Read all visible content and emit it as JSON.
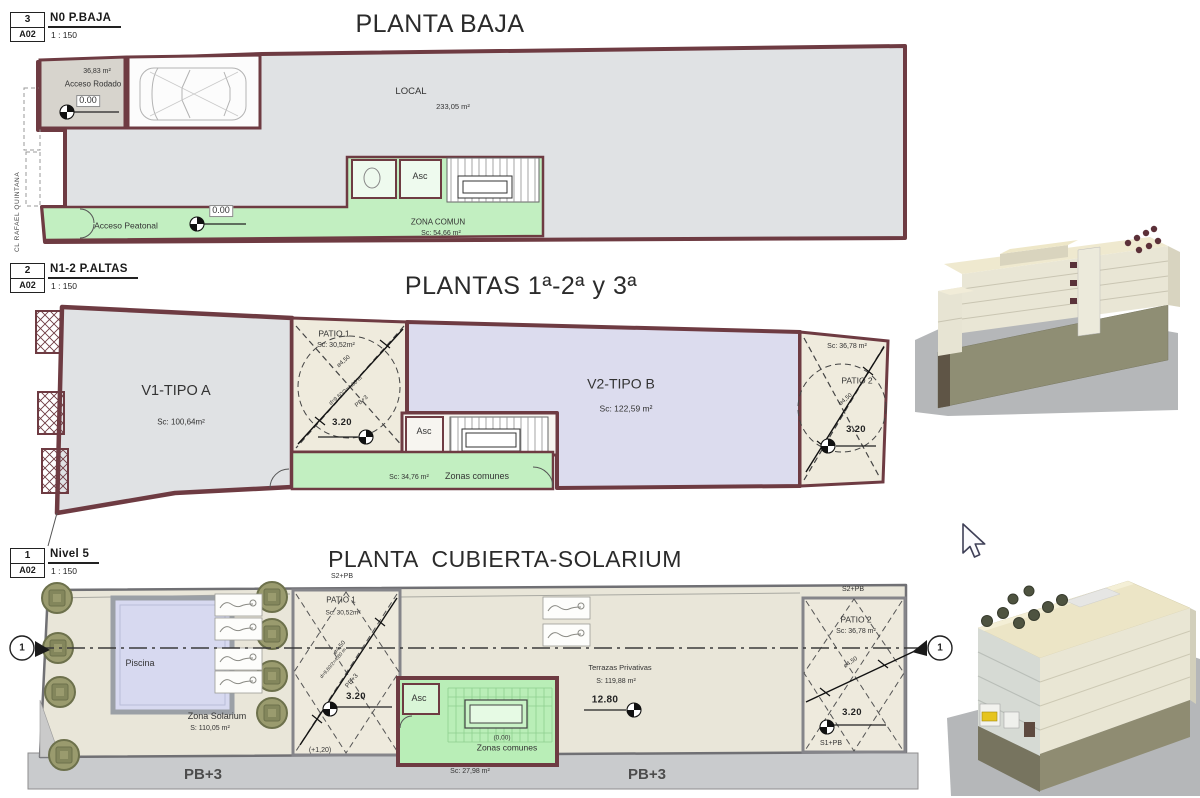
{
  "baja": {
    "ref": {
      "num": "3",
      "sheet": "A02",
      "name": "N0 P.BAJA",
      "scale": "1 : 150"
    },
    "title": "PLANTA BAJA",
    "street": "CL RAFAEL QUINTANA",
    "acceso_rodado_area": "36,83 m²",
    "acceso_rodado": "Acceso Rodado",
    "level_garage": "0.00",
    "local": "LOCAL",
    "local_area": "233,05 m²",
    "asc": "Asc",
    "acceso_peatonal": "Acceso Peatonal",
    "level_corridor": "0.00",
    "zona_comun": "ZONA COMUN",
    "zona_comun_area": "Sc: 54,66 m²"
  },
  "altas": {
    "ref": {
      "num": "2",
      "sheet": "A02",
      "name": "N1-2 P.ALTAS",
      "scale": "1 : 150"
    },
    "title": "PLANTAS 1ª-2ª y 3ª",
    "v1": "V1-TIPO A",
    "v1_area": "Sc: 100,64m²",
    "patio1": "PATIO 1",
    "patio1_area": "Sc: 30,52m²",
    "patio1_dia": "ø4,50",
    "patio1_dim": "d=9,60/2=4,80 m",
    "patio1_pb": "PB+3",
    "patio1_level": "3.20",
    "asc": "Asc",
    "zc_area": "Sc: 34,76 m²",
    "zc": "Zonas comunes",
    "v2": "V2-TIPO B",
    "v2_area": "Sc: 122,59 m²",
    "patio2_area": "Sc: 36,78 m²",
    "patio2": "PATIO 2",
    "patio2_dia": "ø4,50",
    "patio2_level": "3.20"
  },
  "cubierta": {
    "ref": {
      "num": "1",
      "sheet": "A02",
      "name": "Nivel 5",
      "scale": "1 : 150"
    },
    "title": "PLANTA CUBIERTA-SOLARIUM",
    "s2pb_left": "S2+PB",
    "s2pb_right": "S2+PB",
    "s1pb": "S1+PB",
    "patio1": "PATIO 1",
    "patio1_area": "Sc: 30,52m²",
    "piscina": "Piscina",
    "solarium": "Zona Solarium",
    "solarium_area": "S: 110,05 m²",
    "patio1_dia": "ø4,50",
    "patio1_dim": "d=9,60/2=4,80 m",
    "patio1_pb": "PB+3",
    "patio1_level": "3.20",
    "plus120": "(+1,20)",
    "asc": "Asc",
    "zc_level": "(0,00)",
    "zc": "Zonas comunes",
    "zc_area": "Sc: 27,98 m²",
    "terrazas": "Terrazas Privativas",
    "terrazas_area": "S: 119,88 m²",
    "level_1280": "12.80",
    "patio2": "PATIO 2",
    "patio2_area": "Sc: 36,78 m²",
    "patio2_dia": "ø4,50",
    "patio2_level": "3.20",
    "pb3_left": "PB+3",
    "pb3_right": "PB+3",
    "section_left": "1",
    "section_right": "1"
  },
  "colors": {
    "wall": "#6e3b42",
    "floor_gray": "#e0e2e4",
    "green_common": "#c2efc1",
    "lavender": "#dcdcee",
    "patio_beige": "#efebdd",
    "terrace": "#e9e6d9",
    "sidewalk": "#c9cbcd",
    "pool": "#d7d9f0",
    "planter": "#9a9b6e",
    "shadow": "#b5b7b9",
    "cream": "#e9e6d5",
    "olive": "#8f8e74"
  }
}
